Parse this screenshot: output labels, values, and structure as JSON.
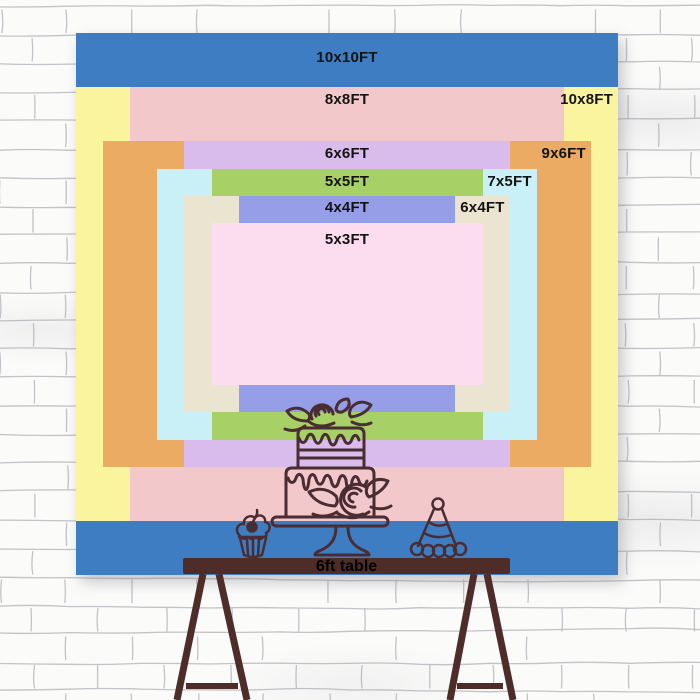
{
  "backdrop": {
    "unit": "FT",
    "label_color": "#141414",
    "sizes": [
      {
        "label": "10x10FT",
        "width_ft": 10,
        "height_ft": 10,
        "color": "#3e7dc2",
        "label_pos": "center"
      },
      {
        "label": "10x8FT",
        "width_ft": 10,
        "height_ft": 8,
        "color": "#fbf49e",
        "label_pos": "right"
      },
      {
        "label": "8x8FT",
        "width_ft": 8,
        "height_ft": 8,
        "color": "#f3c8ca",
        "label_pos": "center"
      },
      {
        "label": "9x6FT",
        "width_ft": 9,
        "height_ft": 6,
        "color": "#ebab62",
        "label_pos": "right"
      },
      {
        "label": "6x6FT",
        "width_ft": 6,
        "height_ft": 6,
        "color": "#d9bcec",
        "label_pos": "center"
      },
      {
        "label": "7x5FT",
        "width_ft": 7,
        "height_ft": 5,
        "color": "#c9eff7",
        "label_pos": "right"
      },
      {
        "label": "5x5FT",
        "width_ft": 5,
        "height_ft": 5,
        "color": "#a7d167",
        "label_pos": "center"
      },
      {
        "label": "6x4FT",
        "width_ft": 6,
        "height_ft": 4,
        "color": "#ebe4d1",
        "label_pos": "right"
      },
      {
        "label": "4x4FT",
        "width_ft": 4,
        "height_ft": 4,
        "color": "#969ee8",
        "label_pos": "center"
      },
      {
        "label": "5x3FT",
        "width_ft": 5,
        "height_ft": 3,
        "color": "#fcdcef",
        "label_pos": "center"
      }
    ]
  },
  "table": {
    "label": "6ft table",
    "length_ft": 6,
    "wood_color": "#4e2d29",
    "label_color": "#000000"
  },
  "illustrations": {
    "stroke_color": "#4a2c33",
    "items": [
      {
        "name": "cupcake"
      },
      {
        "name": "tiered-cake"
      },
      {
        "name": "party-hat"
      }
    ]
  },
  "wall": {
    "base_color": "#fbfbfa",
    "mortar_line_color": "#b7b8be"
  }
}
